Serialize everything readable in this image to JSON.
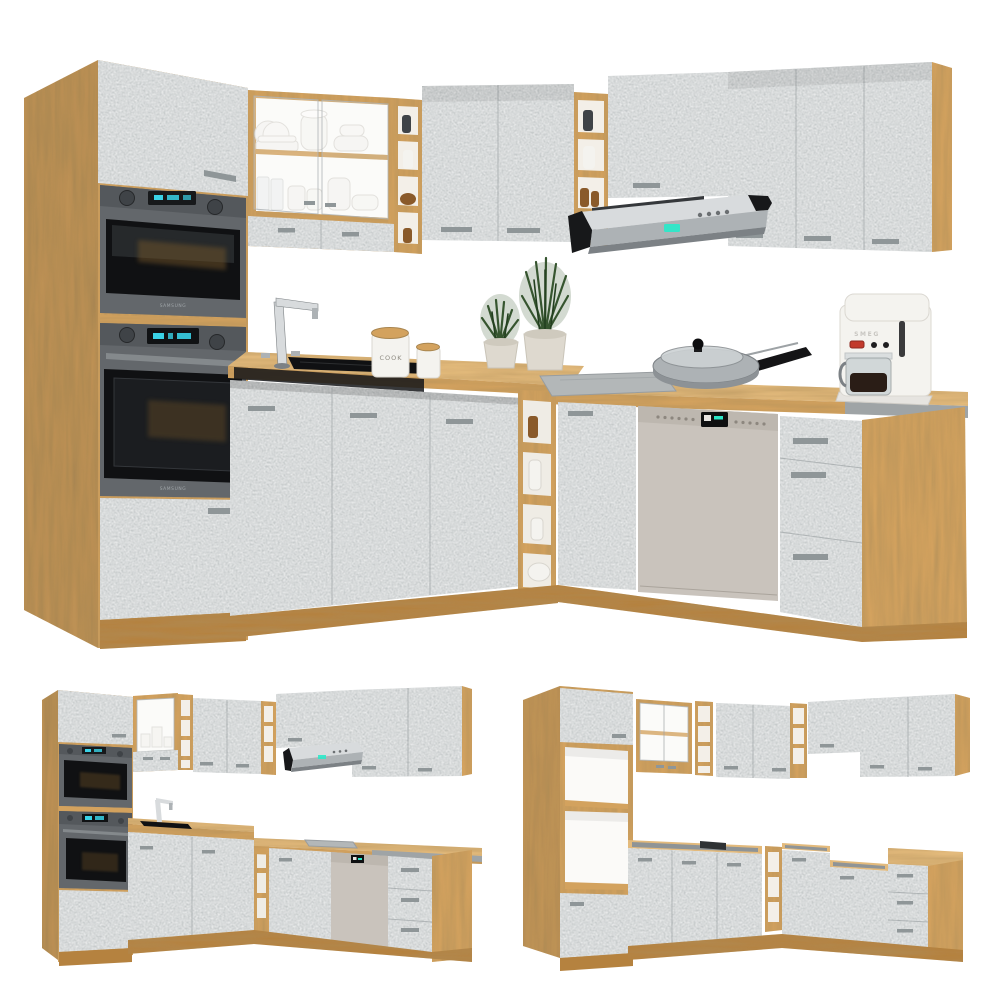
{
  "canvas": {
    "width": 1000,
    "height": 1000,
    "background": "#ffffff"
  },
  "palette": {
    "wood": "#d3a25e",
    "wood_light": "#e3ba7c",
    "wood_dark": "#b5823f",
    "wood_deep": "#96682e",
    "concrete": "#c6cacb",
    "concrete_light": "#d8dcdd",
    "concrete_dark": "#a9afb1",
    "handle": "#8f9698",
    "appliance_frame": "#63676b",
    "appliance_dark": "#3f4347",
    "glass_black": "#101113",
    "steel_light": "#d8dbdd",
    "steel": "#adb2b5",
    "steel_dark": "#7c8185",
    "led_blue": "#3ad2e6",
    "led_teal": "#2de8c9",
    "counter_edge_grey": "#9fa4a6",
    "dishwasher_panel": "#c9c3bc",
    "ceramic_white": "#f4f3ef",
    "ceramic_shadow": "#d9d7d1",
    "plant_green": "#36552f",
    "plant_green_dark": "#233f1f",
    "pot_beige": "#ded9cf",
    "amber_jar": "#8a5a2a",
    "coffee_dark": "#2a1d16",
    "smeg_red": "#c23a2c"
  },
  "branding": {
    "oven_upper_brand": "SAMSUNG",
    "oven_lower_brand": "SAMSUNG",
    "canister_label": "COOK",
    "coffee_maker_brand": "SMEG"
  },
  "views": [
    {
      "id": "main",
      "label": "L-shaped corner kitchen in concrete grey and oak, furnished with ovens, hood, sink, hob, dishwasher and decor"
    },
    {
      "id": "angle",
      "label": "Same corner kitchen seen from the opposite angle with appliances"
    },
    {
      "id": "carcass",
      "label": "Same corner kitchen shown empty without appliances or worktop"
    }
  ]
}
